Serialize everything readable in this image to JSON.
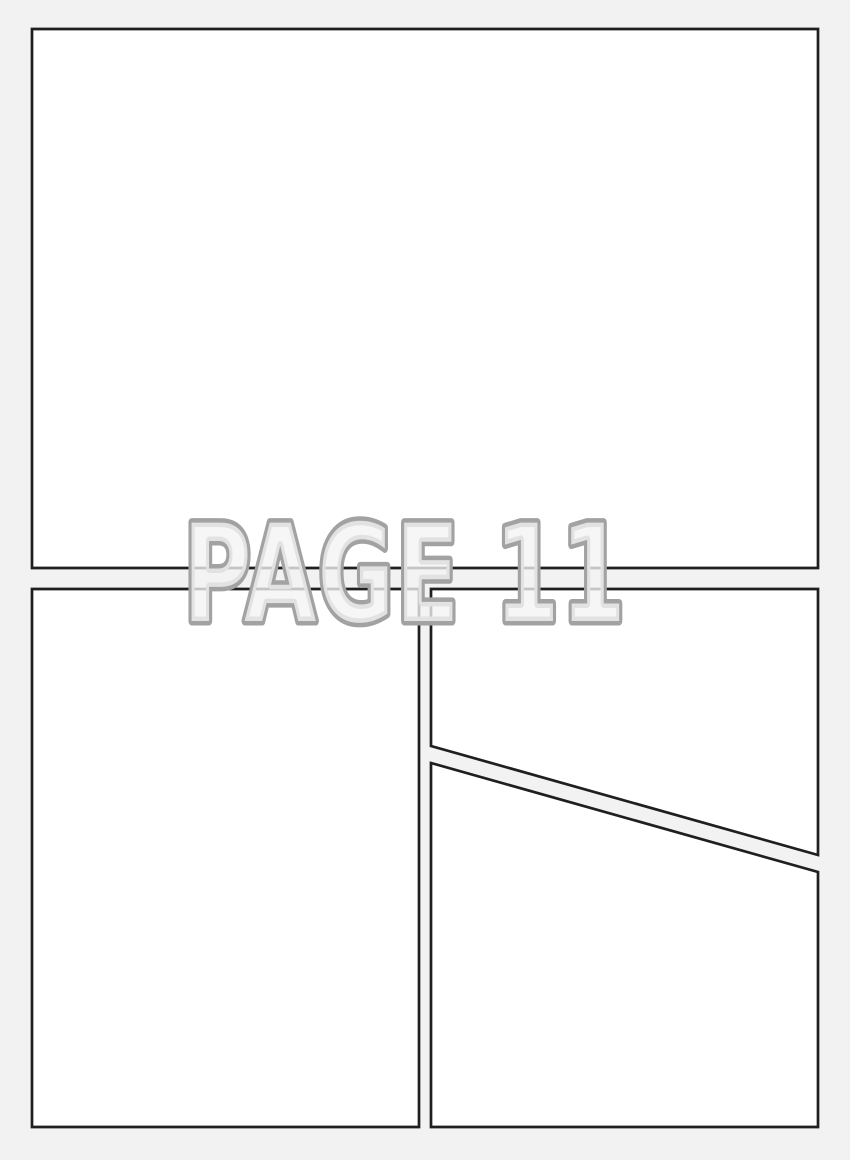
{
  "page": {
    "label": "PAGE 11",
    "background_color": "#f2f2f2",
    "panel_fill": "#ffffff",
    "panel_border_color": "#1f1f1f",
    "label_outline_color": "#a2a2a2",
    "label_fill_color": "#f4f4f4",
    "panel_count": 4
  }
}
